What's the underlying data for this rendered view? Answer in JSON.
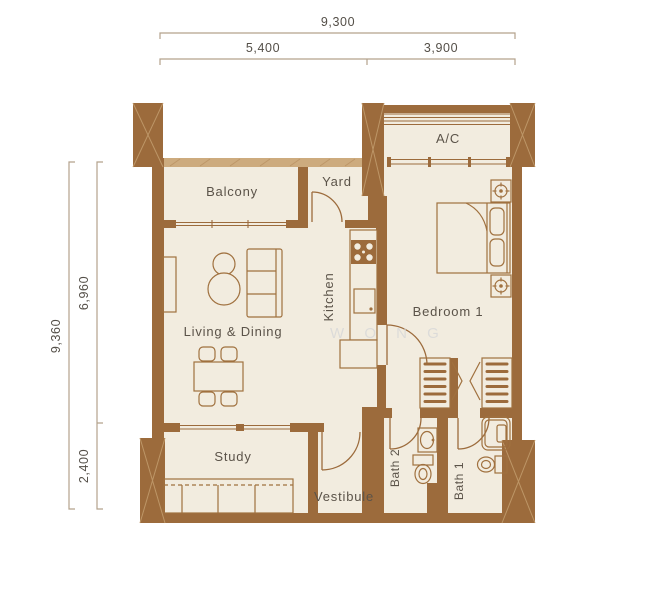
{
  "dimensions": {
    "top_total": "9,300",
    "top_left": "5,400",
    "top_right": "3,900",
    "side_total": "9,360",
    "side_upper": "6,960",
    "side_lower": "2,400"
  },
  "rooms": {
    "balcony": "Balcony",
    "yard": "Yard",
    "ac": "A/C",
    "kitchen": "Kitchen",
    "living_dining": "Living & Dining",
    "bedroom1": "Bedroom 1",
    "study": "Study",
    "vestibule": "Vestibule",
    "bath2": "Bath 2",
    "bath1": "Bath 1"
  },
  "watermark": "W O N G",
  "colors": {
    "wall": "#9c6b3c",
    "wall_hatch": "#bd9667",
    "floor": "#f2ecdf",
    "dimension_line": "#b3a28c",
    "dimension_text": "#544f48",
    "label_text": "#5b5349",
    "watermark_text": "#d9d9d9",
    "background": "#ffffff"
  }
}
